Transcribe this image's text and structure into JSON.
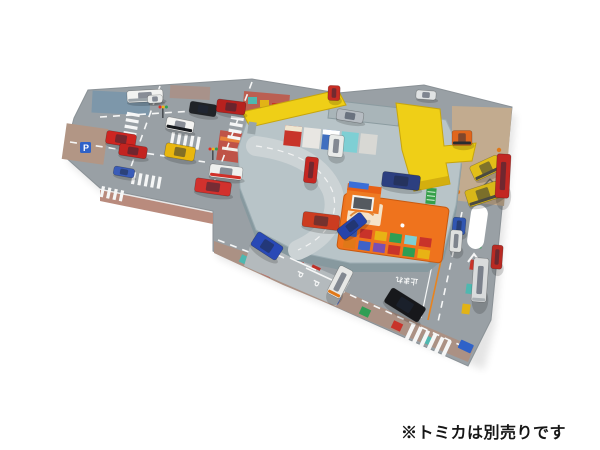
{
  "caption": {
    "text": "※トミカは別売りです",
    "color": "#161616"
  },
  "mat": {
    "markings": {
      "speed_limit": "60",
      "stop_text": "止まれ",
      "parking_letter": "P"
    }
  },
  "palette": {
    "background": "#ffffff",
    "mat_road_gray": "#99a0a5",
    "sidewalk_pink": "#b98b7d",
    "construction_tan": "#c2ab8f",
    "base_plastic_gray": "#b8c4c8",
    "highway_yellow": "#efcf17",
    "building_orange": "#ef731d",
    "sign_blue": "#3a6fd8",
    "lane_line_orange": "#e8831f",
    "marking_white": "#ffffff"
  },
  "vehicles": [
    {
      "id": "white-bus",
      "color": "#f2f3f1",
      "accent": "#9ba3a8",
      "x": 145,
      "y": 96,
      "w": 36,
      "h": 12,
      "r": -3
    },
    {
      "id": "white-sedan-topleft",
      "color": "#e9ebea",
      "x": 155,
      "y": 99,
      "w": 15,
      "h": 8,
      "r": -3
    },
    {
      "id": "fire-truck-a",
      "color": "#ce2621",
      "x": 121,
      "y": 139,
      "w": 30,
      "h": 13,
      "r": 9
    },
    {
      "id": "fire-truck-b",
      "color": "#c32420",
      "x": 133,
      "y": 151,
      "w": 28,
      "h": 12,
      "r": 9
    },
    {
      "id": "police-car",
      "color": "#f4f4f2",
      "accent": "#15181c",
      "x": 180,
      "y": 125,
      "w": 28,
      "h": 12,
      "r": 11
    },
    {
      "id": "black-suv",
      "color": "#202327",
      "x": 203,
      "y": 109,
      "w": 27,
      "h": 12,
      "r": 9
    },
    {
      "id": "red-bus",
      "color": "#b7211e",
      "x": 231,
      "y": 107,
      "w": 29,
      "h": 13,
      "r": 7
    },
    {
      "id": "yellow-taxi",
      "color": "#e9b70e",
      "x": 180,
      "y": 152,
      "w": 30,
      "h": 14,
      "r": 10
    },
    {
      "id": "blue-mini-truck",
      "color": "#3a5cb8",
      "x": 124,
      "y": 172,
      "w": 21,
      "h": 9,
      "r": 10
    },
    {
      "id": "red-sedan",
      "color": "#d2312d",
      "x": 213,
      "y": 187,
      "w": 36,
      "h": 14,
      "r": 8
    },
    {
      "id": "ambulance",
      "color": "#eef0ee",
      "accent": "#d03028",
      "x": 226,
      "y": 172,
      "w": 33,
      "h": 13,
      "r": 7
    },
    {
      "id": "fire-engine-vertical",
      "color": "#c52722",
      "x": 311,
      "y": 170,
      "w": 13,
      "h": 26,
      "r": 6
    },
    {
      "id": "silver-car-on-ramp",
      "color": "#b6bcc2",
      "x": 350,
      "y": 116,
      "w": 27,
      "h": 11,
      "r": 9
    },
    {
      "id": "white-van",
      "color": "#e9ebe9",
      "x": 336,
      "y": 146,
      "w": 15,
      "h": 22,
      "r": 5
    },
    {
      "id": "blue-minivan",
      "color": "#2c3f80",
      "x": 401,
      "y": 181,
      "w": 38,
      "h": 15,
      "r": 7
    },
    {
      "id": "red-suv",
      "color": "#cc3c20",
      "x": 321,
      "y": 221,
      "w": 37,
      "h": 15,
      "r": 7
    },
    {
      "id": "blue-sports-car",
      "color": "#2644aa",
      "x": 352,
      "y": 226,
      "w": 30,
      "h": 13,
      "r": -38
    },
    {
      "id": "white-car-topright",
      "color": "#e0e3e4",
      "x": 426,
      "y": 95,
      "w": 20,
      "h": 9,
      "r": 4
    },
    {
      "id": "orange-forklift",
      "color": "#e0661c",
      "accent": "#2a2d30",
      "x": 462,
      "y": 138,
      "w": 20,
      "h": 15,
      "r": 0
    },
    {
      "id": "yellow-excavator",
      "color": "#e2bf18",
      "accent": "#4a4a42",
      "x": 486,
      "y": 168,
      "w": 30,
      "h": 16,
      "r": -25
    },
    {
      "id": "yellow-bulldozer",
      "color": "#d8b719",
      "accent": "#4a4a42",
      "x": 483,
      "y": 194,
      "w": 34,
      "h": 17,
      "r": -18
    },
    {
      "id": "blue-truck-right",
      "color": "#3056b2",
      "x": 459,
      "y": 226,
      "w": 13,
      "h": 17,
      "r": 5
    },
    {
      "id": "white-tank-truck",
      "color": "#dee0df",
      "x": 456,
      "y": 241,
      "w": 12,
      "h": 22,
      "r": 4
    },
    {
      "id": "white-truck-right",
      "color": "#d9dbdc",
      "accent": "#aab0b4",
      "x": 480,
      "y": 280,
      "w": 15,
      "h": 44,
      "r": 4
    },
    {
      "id": "red-ladder-truck",
      "color": "#c22722",
      "x": 503,
      "y": 176,
      "w": 14,
      "h": 44,
      "r": 3
    },
    {
      "id": "red-bus-right",
      "color": "#b92a23",
      "x": 497,
      "y": 257,
      "w": 11,
      "h": 24,
      "r": 4
    },
    {
      "id": "blue-bus-bottom",
      "color": "#2949b6",
      "x": 267,
      "y": 246,
      "w": 30,
      "h": 16,
      "r": 33
    },
    {
      "id": "camper-van",
      "color": "#e7e8e6",
      "accent": "#e07818",
      "x": 340,
      "y": 282,
      "w": 15,
      "h": 31,
      "r": 27
    },
    {
      "id": "black-minivan-bottom",
      "color": "#17181b",
      "x": 405,
      "y": 305,
      "w": 40,
      "h": 17,
      "r": 32
    },
    {
      "id": "red-cab-top",
      "color": "#c62d24",
      "x": 334,
      "y": 93,
      "w": 12,
      "h": 15,
      "r": 2
    }
  ]
}
